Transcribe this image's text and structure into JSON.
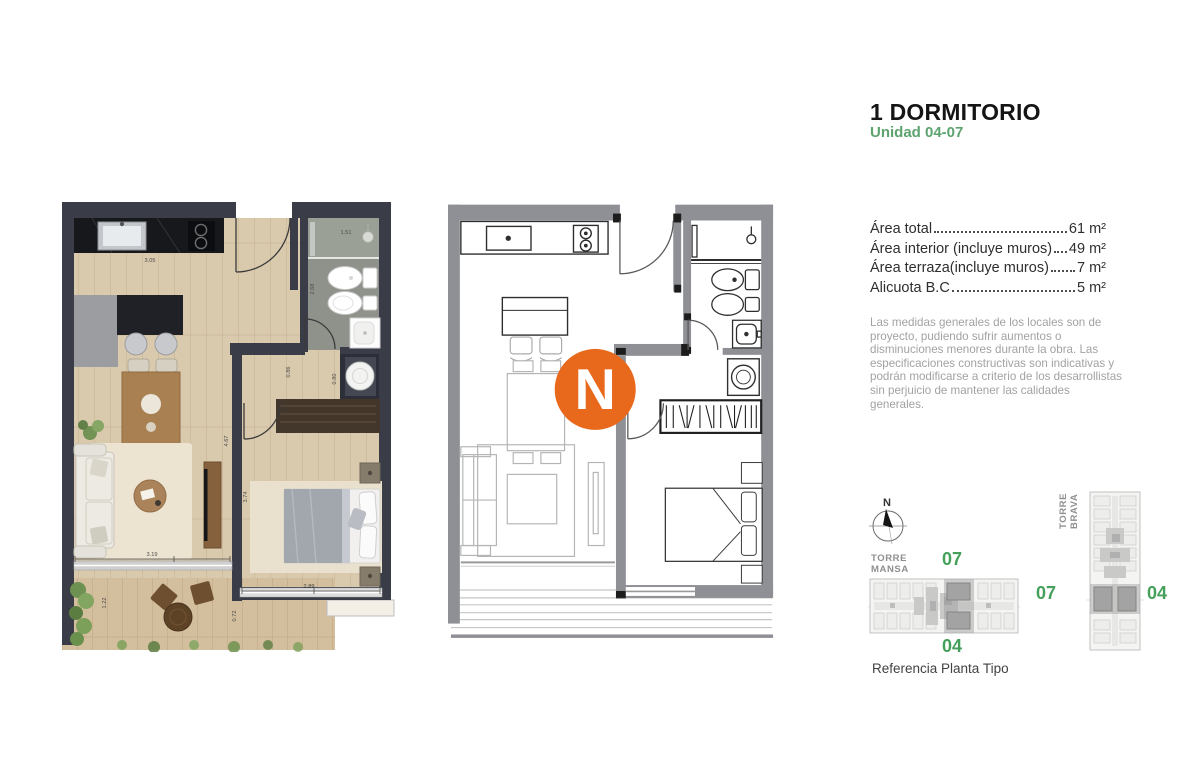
{
  "header": {
    "title": "1 DORMITORIO",
    "subtitle": "Unidad 04-07"
  },
  "areas": {
    "rows": [
      {
        "label": "Área total",
        "value": "61 m²"
      },
      {
        "label": "Área interior (incluye muros)",
        "value": "49 m²"
      },
      {
        "label": "Área terraza(incluye muros)",
        "value": "7 m²"
      },
      {
        "label": "Alicuota B.C",
        "value": "5 m²"
      }
    ]
  },
  "disclaimer": "Las medidas generales de los locales son de proyecto, pudiendo sufrir aumentos o disminuciones menores durante la obra. Las especificaciones constructivas son indicativas y podrán modificarse a criterio de los desarrollistas sin perjuicio de mantener las calidades generales.",
  "compass": {
    "north_label": "N"
  },
  "logo": {
    "letter": "N"
  },
  "plans": {
    "dims": {
      "kitchen_width": "3.05",
      "shower_width": "1.51",
      "bath_length": "2.68",
      "hall_width": "0.86",
      "laundry_width": "0.80",
      "living_length": "4.67",
      "bedroom_length": "3.74",
      "living_width": "3.19",
      "bedroom_width": "2.89",
      "terrace_depth": "1.22",
      "terrace_side": "0.72"
    }
  },
  "reference": {
    "caption": "Referencia Planta Tipo",
    "towers": [
      {
        "name_line1": "TORRE",
        "name_line2": "MANSA",
        "unit_top": "07",
        "unit_bottom": "04"
      },
      {
        "name_line1": "TORRE",
        "name_line2": "BRAVA",
        "unit_left": "07",
        "unit_right": "04"
      }
    ]
  },
  "colors": {
    "accent_green": "#5da36f",
    "unit_green": "#44a05a",
    "logo_orange": "#e8681c",
    "wall_dark": "#3a3d47",
    "wall_gray": "#8e9095"
  }
}
